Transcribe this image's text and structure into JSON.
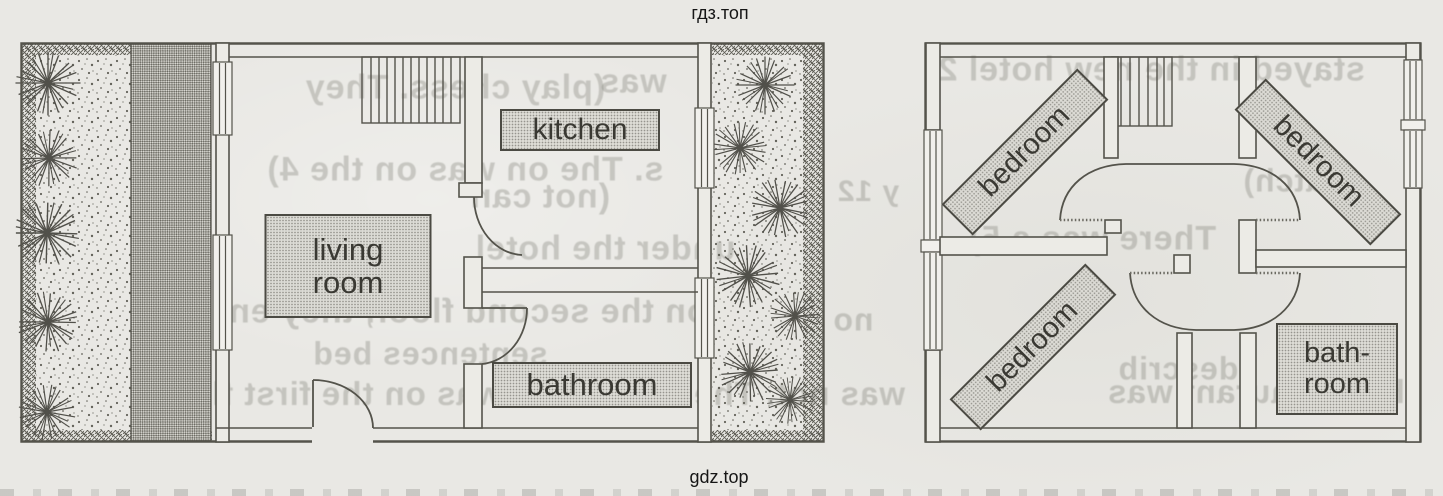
{
  "watermark": {
    "top": "гдз.топ",
    "bottom": "gdz.top"
  },
  "ground_floor_plan": {
    "kitchen_label": "kitchen",
    "living_room_label_line1": "living",
    "living_room_label_line2": "room",
    "bathroom_label": "bathroom"
  },
  "upper_floor_plan": {
    "bedroom_top_left_label": "bedroom",
    "bedroom_top_right_label": "bedroom",
    "bedroom_bottom_left_label": "bedroom",
    "bathroom_label_line1": "bath-",
    "bathroom_label_line2": "room"
  },
  "bleed_through_text": {
    "fragments": [
      "stayed in the new hotel 2)",
      "(play chess. They",
      "was",
      "s. The on was on the 4)",
      "(not can",
      "y 12",
      "(watch)",
      "under the hotel",
      "There was a 5)",
      "on the second floor, they en",
      "sentences bed",
      "describ",
      "was not. The restaurant was on the first floor",
      "the restaurant was",
      "no"
    ]
  },
  "colors": {
    "paper": "#e9e8e4",
    "ink": "#54534b",
    "label_fill": "#dcdbd5",
    "label_text": "#3a3933",
    "watermark_text": "#161616"
  }
}
